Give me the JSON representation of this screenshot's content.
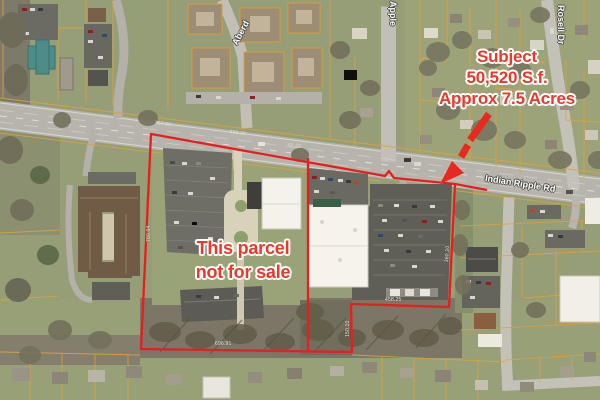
{
  "annotations": {
    "subject": {
      "line1": "Subject",
      "line2": "50,520 S.f.",
      "line3": "Approx 7.5 Acres"
    },
    "not_for_sale": {
      "line1": "This parcel",
      "line2": "not for sale"
    }
  },
  "road_labels": {
    "indian_ripple": "Indian Ripple Rd",
    "rosell": "Rosell Dr",
    "apple": "Apple",
    "aberdeen": "Aberd"
  },
  "dimension_labels": {
    "road_west": "727.32",
    "road_center": "592.20",
    "road_east": "45.20",
    "parcel_west": "780.04",
    "parcel_south_west": "696.91",
    "parcel_south_east": "458.25",
    "parcel_notch": "150.10",
    "parcel_east": "380.20"
  },
  "colors": {
    "annotation_red": "#e8392b",
    "boundary_red": "#e81e1e",
    "parcel_line_orange": "#dfa23b",
    "gis_label_white": "#ffffff"
  }
}
